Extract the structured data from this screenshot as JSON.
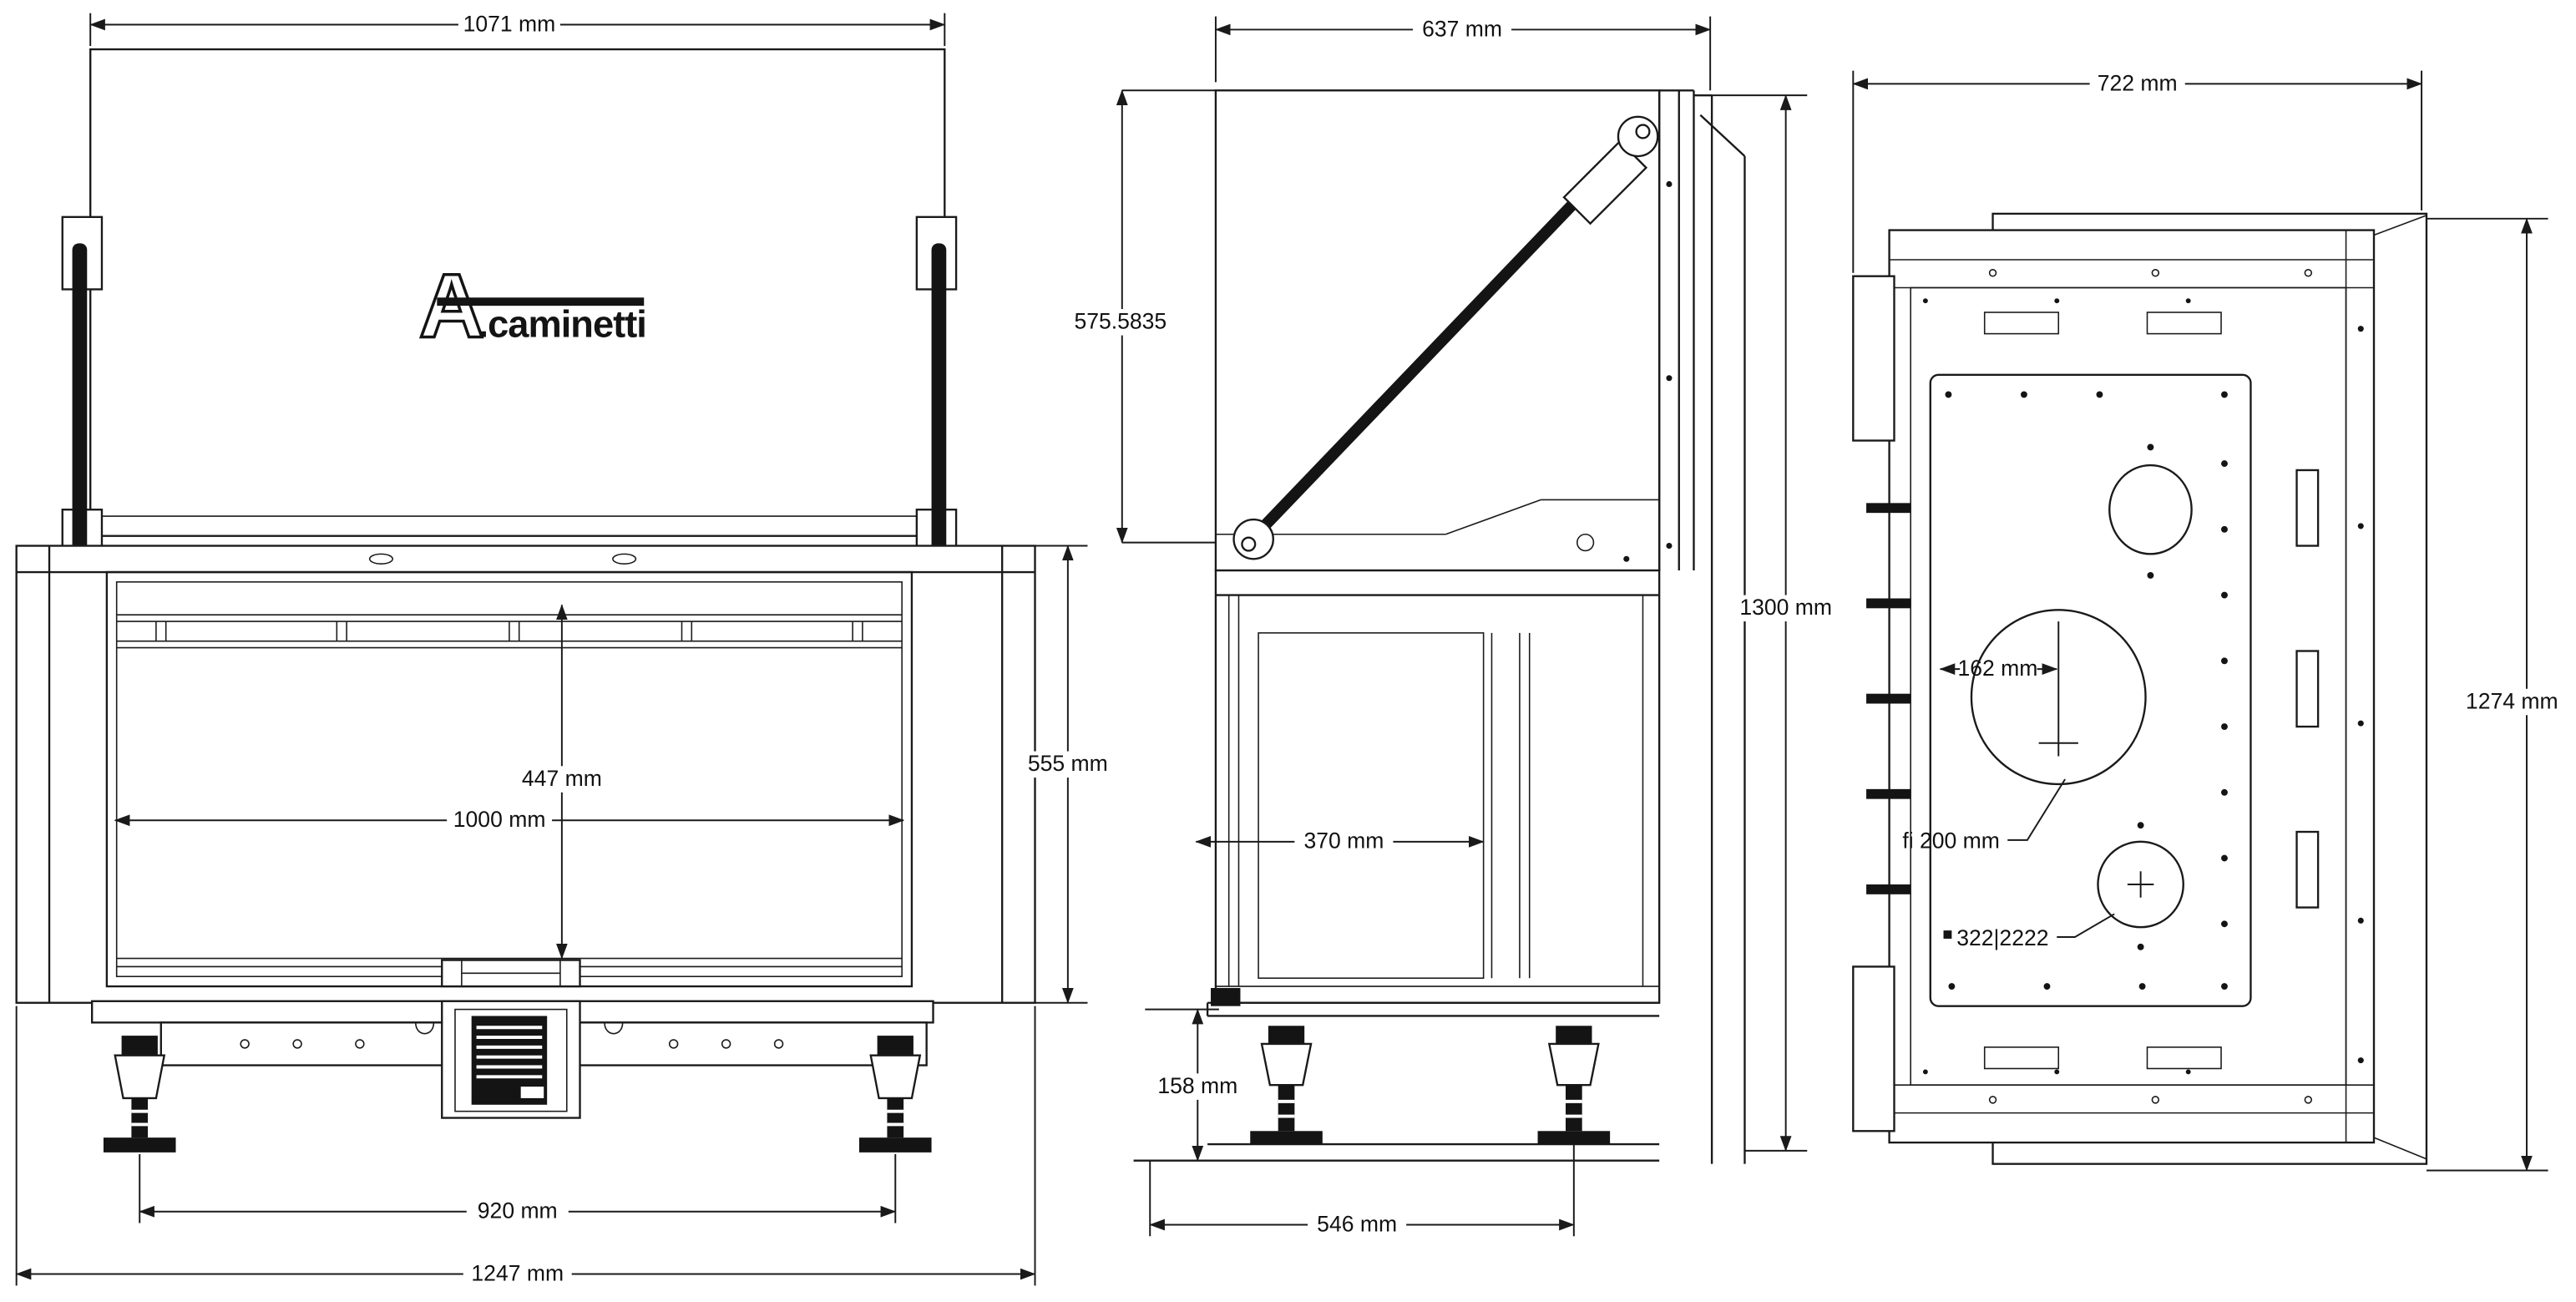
{
  "brand": {
    "initial": "A",
    "rest": ".caminetti"
  },
  "front": {
    "top_width": "1071 mm",
    "glass_height": "447 mm",
    "glass_width": "1000 mm",
    "opening_height": "555 mm",
    "feet_span": "920 mm",
    "overall_width": "1247 mm"
  },
  "side": {
    "top_depth": "637 mm",
    "door_lift": "575.5835",
    "overall_height": "1300 mm",
    "firebox_depth": "370 mm",
    "base_height": "158 mm",
    "base_depth": "546 mm"
  },
  "rear": {
    "top_width": "722 mm",
    "overall_height": "1274 mm",
    "flue_offset": "162 mm",
    "flue_diameter": "fi 200 mm",
    "socket_code": "322|2222"
  }
}
